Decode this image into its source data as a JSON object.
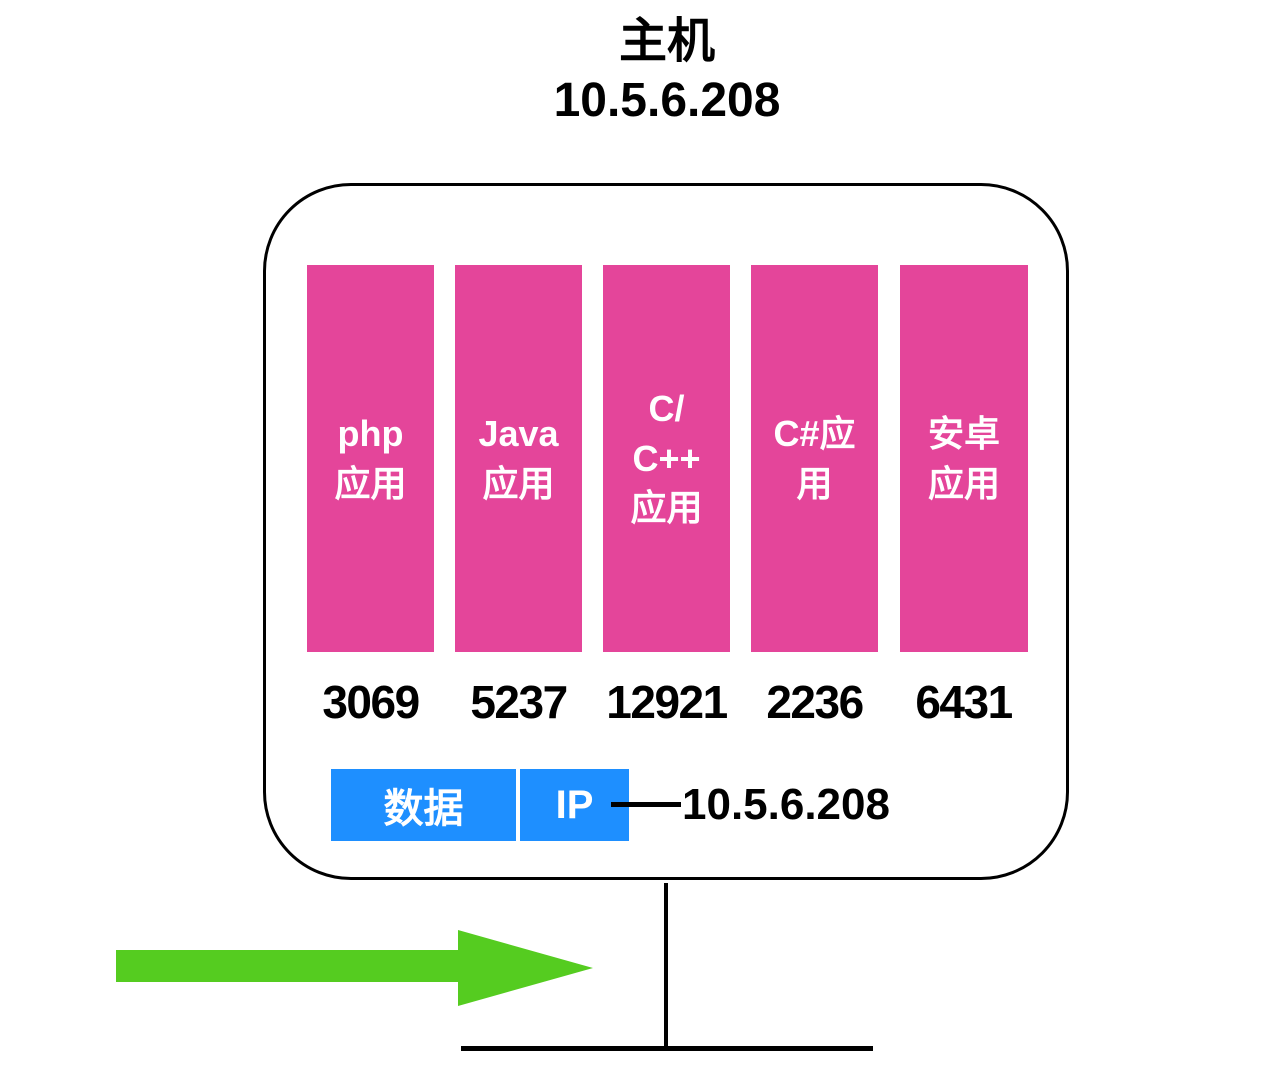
{
  "header": {
    "title": "主机",
    "host_ip": "10.5.6.208"
  },
  "host": {
    "apps": [
      {
        "label": "php\n应用",
        "port": "3069"
      },
      {
        "label": "Java\n应用",
        "port": "5237"
      },
      {
        "label": "C/\nC++\n应用",
        "port": "12921"
      },
      {
        "label": "C#应\n用",
        "port": "2236"
      },
      {
        "label": "安卓\n应用",
        "port": "6431"
      }
    ],
    "packet": {
      "data_label": "数据",
      "protocol_label": "IP",
      "ip_value": "10.5.6.208"
    }
  },
  "colors": {
    "app_bar_pink": "#e4459a",
    "packet_blue": "#1e8fff",
    "arrow_green": "#55cc20",
    "line_black": "#000000"
  }
}
